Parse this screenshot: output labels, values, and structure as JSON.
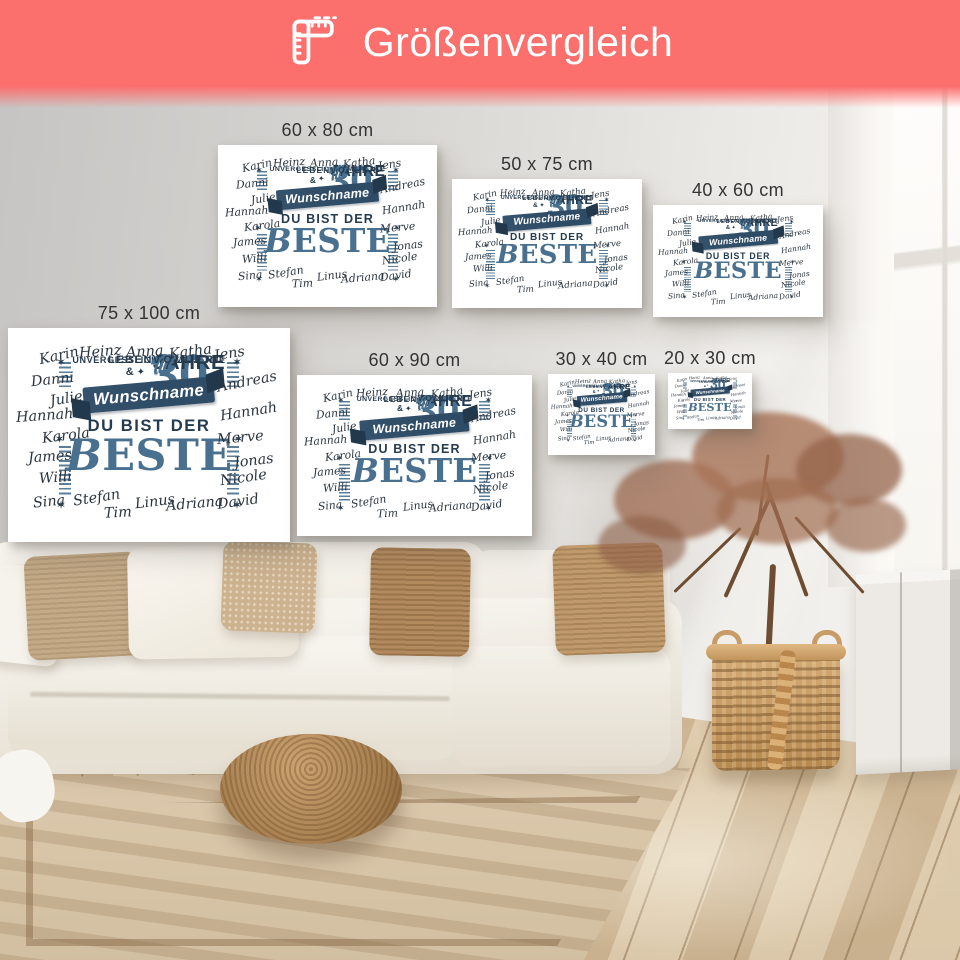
{
  "header": {
    "title": "Größenvergleich"
  },
  "colors": {
    "banner": "#fb6f6d",
    "steel_blue": "#49708f",
    "dark_navy": "#253b4f",
    "ribbon_blue": "#2f4c66",
    "canvas": "#ffffff"
  },
  "posters": {
    "sizes": [
      {
        "label": "60 x 80 cm"
      },
      {
        "label": "50 x 75 cm"
      },
      {
        "label": "40 x 60 cm"
      },
      {
        "label": "75 x 100 cm"
      },
      {
        "label": "60 x 90 cm"
      },
      {
        "label": "30 x 40 cm"
      },
      {
        "label": "20 x 30 cm"
      }
    ],
    "design": {
      "age_number": "30",
      "jahre": "JAHRE",
      "voller": "VOLLER",
      "leben": "LEBEN &",
      "momente": "UNVERGESSLICHER MOMENTE",
      "ribbon": "Wunschname",
      "du_bist": "DU BIST DER",
      "beste": "BESTE",
      "names": [
        "Karin",
        "Heinz",
        "Anna",
        "Katha",
        "Jens",
        "Danni",
        "Andreas",
        "Julie",
        "Hannah",
        "Hannah",
        "Karola",
        "Merve",
        "James",
        "Jonas",
        "Willi",
        "Nicole",
        "Sina",
        "Stefan",
        "Tim",
        "Linus",
        "Adriana",
        "David"
      ],
      "decor": {
        "star": "✶",
        "sparkle": "✦ ⁎",
        "laurel": "(((("
      }
    }
  }
}
